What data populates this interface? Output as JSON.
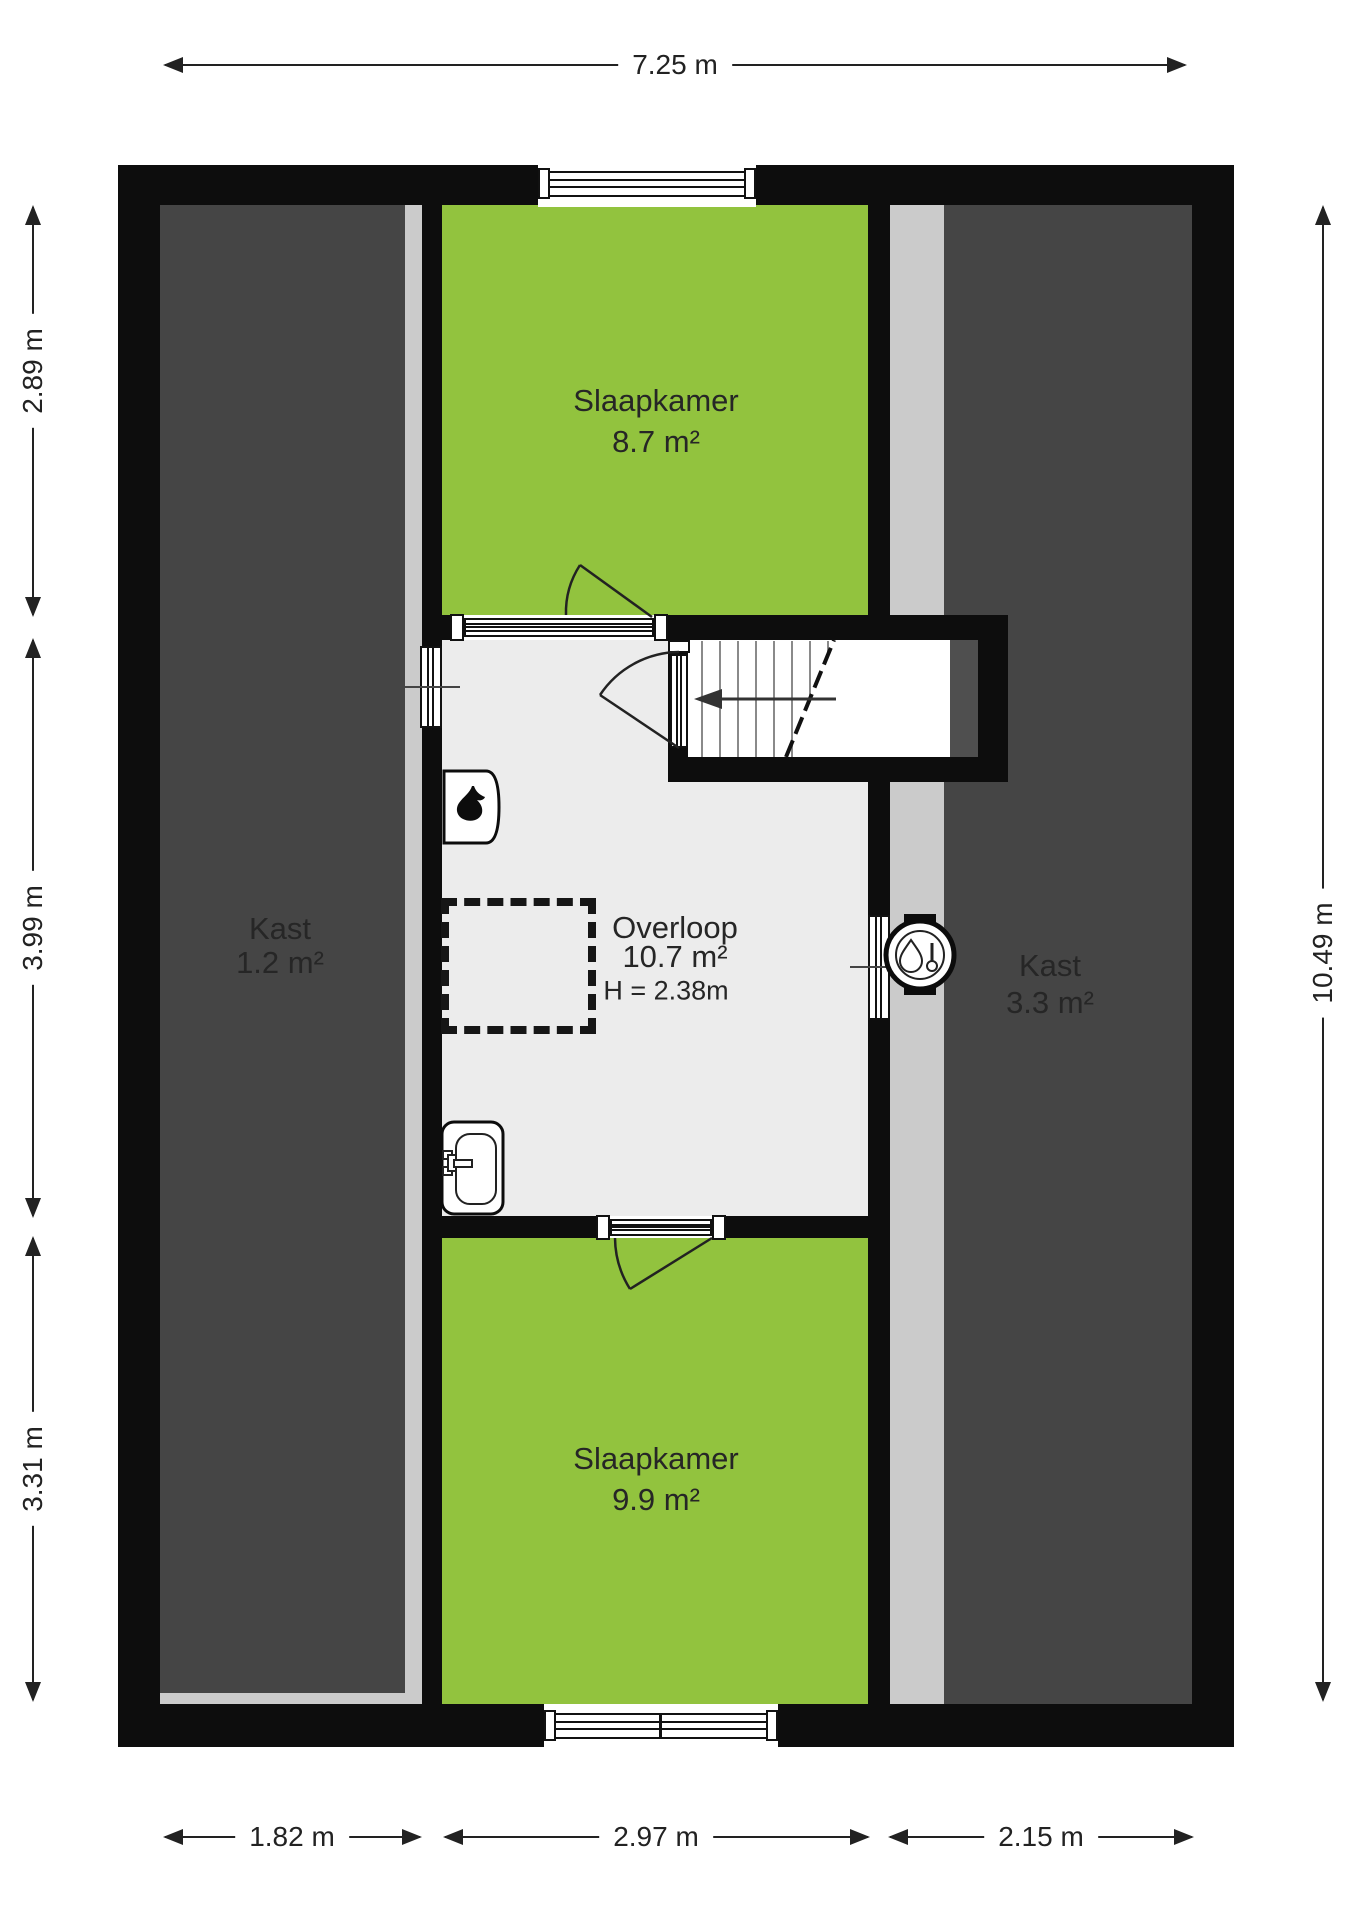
{
  "plan_title": "floor-plan-attic",
  "dimensions": {
    "top": "7.25 m",
    "right": "10.49 m",
    "left": [
      "2.89 m",
      "3.99 m",
      "3.31 m"
    ],
    "bottom": [
      "1.82 m",
      "2.97 m",
      "2.15 m"
    ]
  },
  "rooms": {
    "bedroom_top": {
      "name": "Slaapkamer",
      "area": "8.7 m²"
    },
    "closet_left": {
      "name": "Kast",
      "area": "1.2 m²"
    },
    "landing": {
      "name": "Overloop",
      "area": "10.7 m²",
      "ceiling_height": "H = 2.38m"
    },
    "closet_right": {
      "name": "Kast",
      "area": "3.3 m²"
    },
    "bedroom_bottom": {
      "name": "Slaapkamer",
      "area": "9.9 m²"
    }
  },
  "colors": {
    "wall": "#0d0d0d",
    "bedroom_green": "#92c33e",
    "closet_dark_gray": "#454545",
    "sloped_edge_light_gray": "#cbcbcb",
    "landing_floor_gray": "#ececec",
    "stair_inner_shadow": "#4f4f4f"
  },
  "icons": {
    "boiler": "flame-icon",
    "water_heater": "water-heater-icon",
    "washbasin": "sink-icon",
    "stair_direction": "arrow-left-icon",
    "shower_zone": "dashed-square"
  }
}
